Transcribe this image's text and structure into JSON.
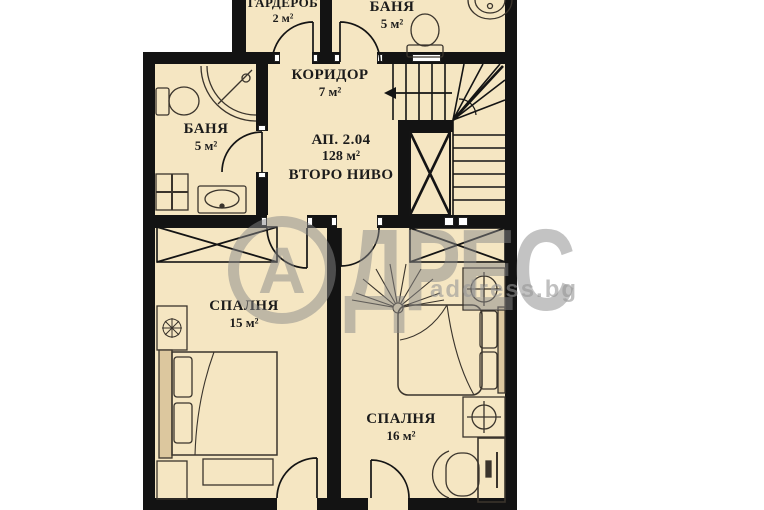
{
  "floorplan": {
    "apartment": {
      "id": "АП. 2.04",
      "total_area": "128 м²",
      "level": "ВТОРО НИВО"
    },
    "rooms": {
      "wardrobe": {
        "name": "ГАРДЕРОБ",
        "area": "2 м²"
      },
      "bath_top": {
        "name": "БАНЯ",
        "area": "5 м²"
      },
      "corridor": {
        "name": "КОРИДОР",
        "area": "7 м²"
      },
      "bath_left": {
        "name": "БАНЯ",
        "area": "5 м²"
      },
      "bedroom_left": {
        "name": "СПАЛНЯ",
        "area": "15 м²"
      },
      "bedroom_right": {
        "name": "СПАЛНЯ",
        "area": "16 м²"
      }
    },
    "watermark": {
      "brand_initial": "А",
      "brand_rest": "ДРЕС",
      "website": "address.bg"
    },
    "colors": {
      "floor": "#f5e6c2",
      "wall": "#131313",
      "line": "#2e2a25",
      "watermark": "#878787"
    }
  }
}
